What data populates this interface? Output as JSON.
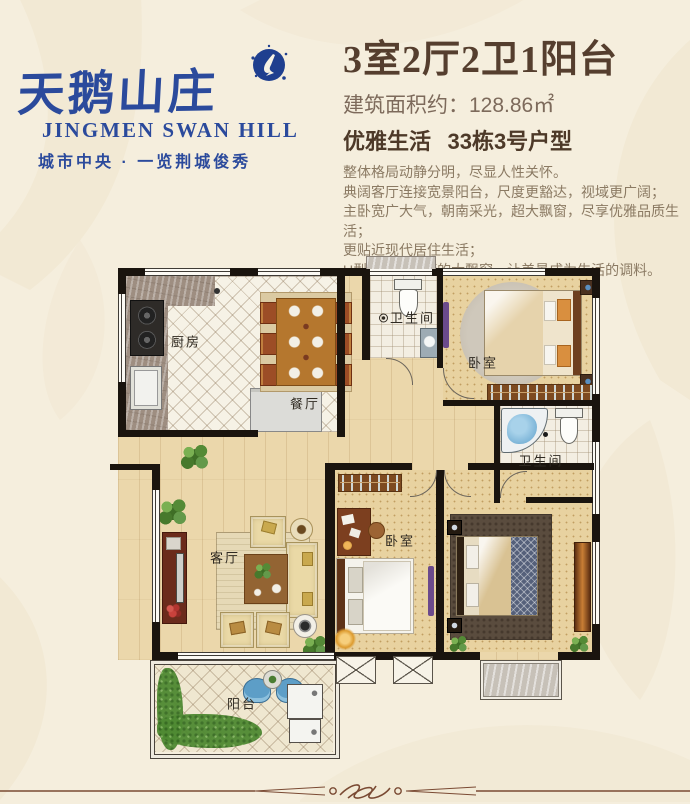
{
  "brand": {
    "name_cn": "天鹅山庄",
    "name_en": "JINGMEN SWAN HILL",
    "tagline": "城市中央 · 一览荆城俊秀",
    "blue": "#2b4a9c"
  },
  "header": {
    "title": "3室2厅2卫1阳台",
    "area_label": "建筑面积约：",
    "area_value": "128.86㎡",
    "lifestyle": "优雅生活",
    "unit_no": "33栋3号户型",
    "desc": [
      "整体格局动静分明，尽显人性关怀。",
      "典阔客厅连接宽景阳台，尺度更豁达，视域更广阔；",
      "主卧宽广大气，朝南采光，超大飘窗，尽享优雅品质生活；",
      "更贴近现代居住生活；",
      "U型厨房与餐厅的大飘窗，让美景成为生活的调料。"
    ]
  },
  "floorplan": {
    "labels": {
      "kitchen": "厨房",
      "dining": "餐厅",
      "bath1": "卫生间",
      "bedroom1": "卧室",
      "bath2": "卫生间",
      "living": "客厅",
      "bedroom2": "卧室",
      "balcony": "阳台"
    },
    "colors": {
      "wall": "#1a140e",
      "wood_floor": "#ebd7ab",
      "bedroom_floor": "#e8d2a0",
      "tile": "#f3eee2",
      "marble": "#9e8e81",
      "purple_accent": "#6b4a8c",
      "tub_blue": "#7db5d8",
      "plant_green": "#4a7d33",
      "rug_dark": "#5a4c3e"
    }
  }
}
